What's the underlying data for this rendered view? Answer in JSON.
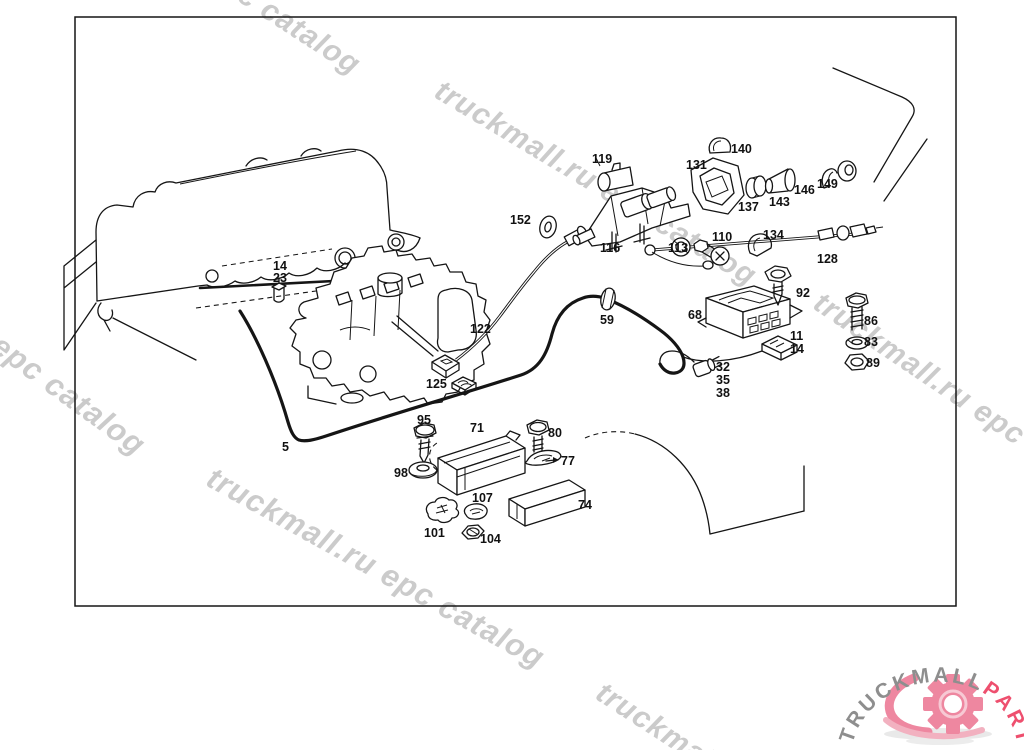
{
  "frame": {
    "stroke": "#151515"
  },
  "watermark": {
    "color": "#cbcbcb",
    "items": [
      {
        "id": "wm-top-left",
        "text": "c catalog",
        "x": 250,
        "y": -22,
        "rot": 33,
        "size": 30
      },
      {
        "id": "wm-top-mid",
        "text": "truckmall.ru epc catalog",
        "x": 446,
        "y": 74,
        "rot": 31,
        "size": 30
      },
      {
        "id": "wm-right",
        "text": "truckmall.ru epc catalog",
        "x": 826,
        "y": 286,
        "rot": 34,
        "size": 30
      },
      {
        "id": "wm-left",
        "text": "l epc catalog",
        "x": -10,
        "y": 316,
        "rot": 36,
        "size": 31
      },
      {
        "id": "wm-bottom",
        "text": "truckmall.ru epc catalog",
        "x": 218,
        "y": 460,
        "rot": 29,
        "size": 31
      },
      {
        "id": "wm-bottom-right",
        "text": "truckmall",
        "x": 608,
        "y": 676,
        "rot": 33,
        "size": 30
      }
    ]
  },
  "logo": {
    "text_gray": "TRUCKMALL",
    "text_pink": "PARTS",
    "gray": "#8e8e8e",
    "pink": "#ee4f6e",
    "gear_pink": "#ee87a0",
    "swoosh_pink": "#f2b1c0",
    "shadow": "#e0e0e0"
  },
  "parts": {
    "label_color": "#111111",
    "labels": [
      {
        "n": "119",
        "x": 592,
        "y": 163
      },
      {
        "n": "140",
        "x": 731,
        "y": 153
      },
      {
        "n": "131",
        "x": 686,
        "y": 169
      },
      {
        "n": "137",
        "x": 738,
        "y": 211
      },
      {
        "n": "143",
        "x": 769,
        "y": 206
      },
      {
        "n": "146",
        "x": 794,
        "y": 194
      },
      {
        "n": "149",
        "x": 817,
        "y": 188
      },
      {
        "n": "152",
        "x": 510,
        "y": 224
      },
      {
        "n": "116",
        "x": 600,
        "y": 252
      },
      {
        "n": "113",
        "x": 668,
        "y": 252
      },
      {
        "n": "110",
        "x": 712,
        "y": 241
      },
      {
        "n": "134",
        "x": 763,
        "y": 239
      },
      {
        "n": "128",
        "x": 817,
        "y": 263
      },
      {
        "n": "92",
        "x": 796,
        "y": 297
      },
      {
        "n": "68",
        "x": 688,
        "y": 319
      },
      {
        "n": "86",
        "x": 864,
        "y": 325
      },
      {
        "n": "83",
        "x": 864,
        "y": 346
      },
      {
        "n": "89",
        "x": 866,
        "y": 367
      },
      {
        "n": "11",
        "x": 790,
        "y": 340
      },
      {
        "n": "14",
        "x": 790,
        "y": 353
      },
      {
        "n": "32",
        "x": 716,
        "y": 371
      },
      {
        "n": "35",
        "x": 716,
        "y": 384
      },
      {
        "n": "38",
        "x": 716,
        "y": 397
      },
      {
        "n": "59",
        "x": 600,
        "y": 324
      },
      {
        "n": "122",
        "x": 470,
        "y": 333
      },
      {
        "n": "125",
        "x": 426,
        "y": 388
      },
      {
        "n": "14",
        "x": 273,
        "y": 270
      },
      {
        "n": "23",
        "x": 273,
        "y": 282
      },
      {
        "n": "5",
        "x": 282,
        "y": 451
      },
      {
        "n": "95",
        "x": 417,
        "y": 424
      },
      {
        "n": "71",
        "x": 470,
        "y": 432
      },
      {
        "n": "80",
        "x": 548,
        "y": 437
      },
      {
        "n": "77",
        "x": 561,
        "y": 465
      },
      {
        "n": "98",
        "x": 394,
        "y": 477
      },
      {
        "n": "107",
        "x": 472,
        "y": 502
      },
      {
        "n": "74",
        "x": 578,
        "y": 509
      },
      {
        "n": "101",
        "x": 424,
        "y": 537
      },
      {
        "n": "104",
        "x": 480,
        "y": 543
      }
    ]
  }
}
